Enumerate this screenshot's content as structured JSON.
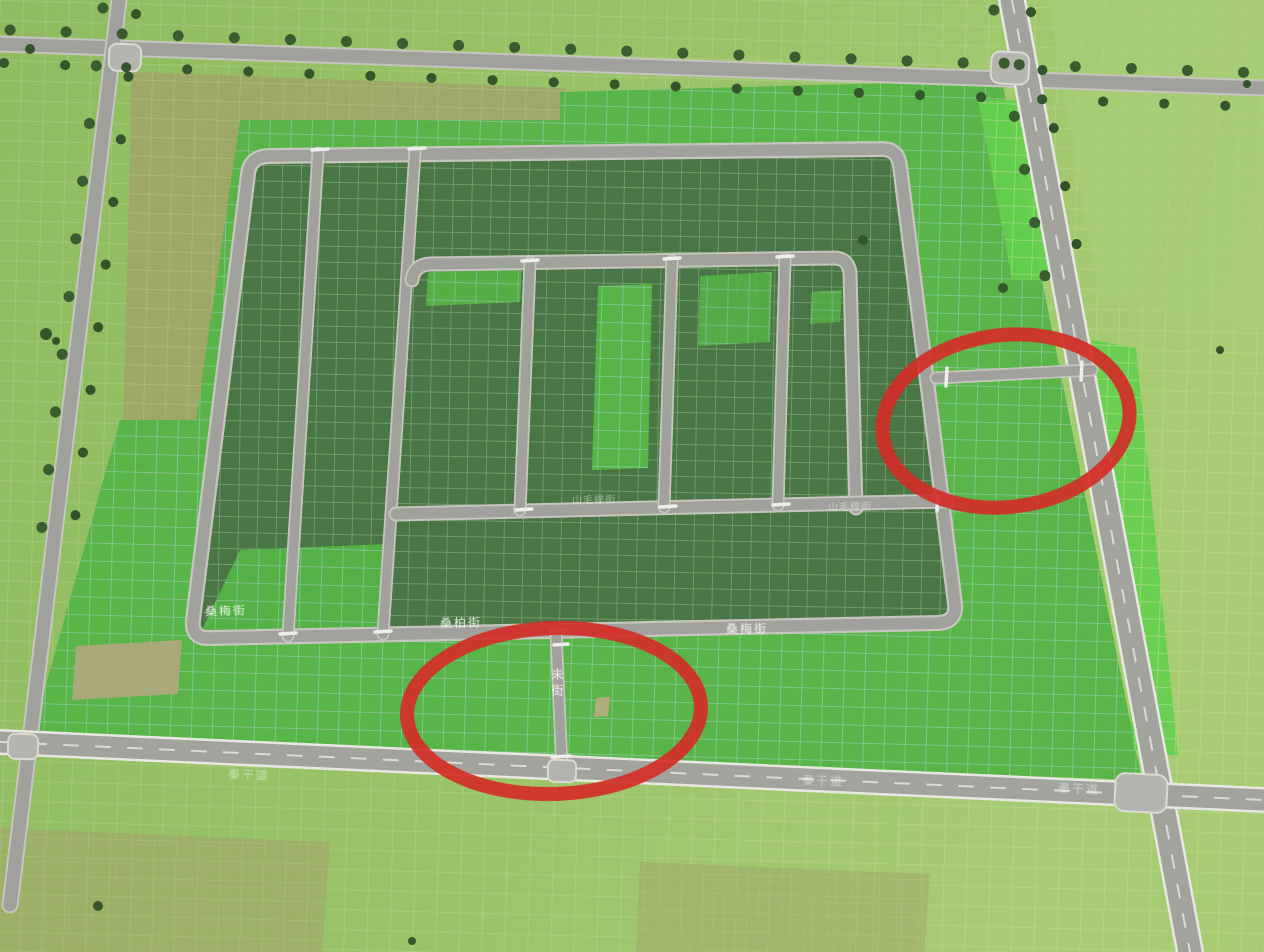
{
  "view": {
    "kind": "city-building game map viewport",
    "terrain_colors": {
      "grass_base": "#97c268",
      "zoned_bright_green": "#55b445",
      "zoned_dark_green": "#4a7544",
      "unzoned_olive": "#9fa468",
      "bare_tan": "#a9a97b",
      "road_gray": "#a0a09c",
      "road_edge": "#c7c7c0"
    },
    "streets": {
      "loop_label_left": "桑梅街",
      "loop_label_mid": "桑柏街",
      "loop_label_right": "桑梅街",
      "mid_label_1": "山毛榉街",
      "mid_label_2": "山毛榉街",
      "stub_label": "未街",
      "avenue_label_1": "秦干道",
      "avenue_label_2": "秦干道",
      "avenue_label_3": "秦干道"
    },
    "annotations": {
      "shape": "ellipse",
      "color": "#d22f27",
      "count": 2,
      "meaning": "hand-drawn red circles highlighting two road junctions"
    }
  }
}
